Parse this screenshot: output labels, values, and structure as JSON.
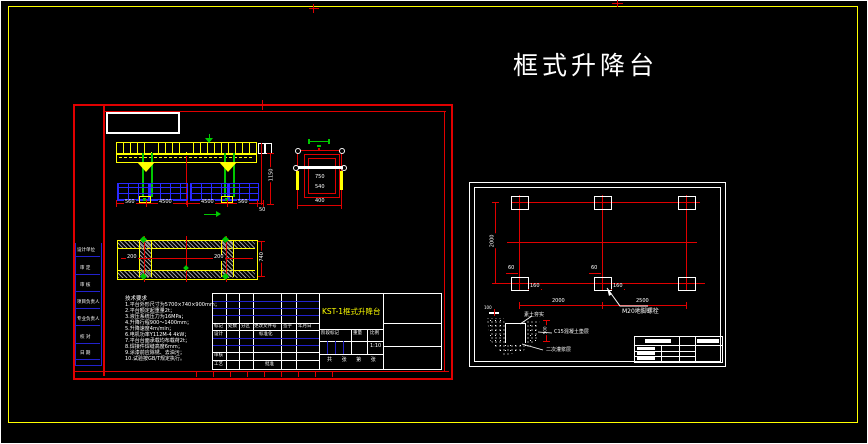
{
  "page": {
    "title": "框式升降台"
  },
  "colors": {
    "red": "#e00000",
    "yellow": "#ffff00",
    "green": "#00c800",
    "blue": "#2222cc",
    "white": "#ffffff",
    "hatch_gray": "#999999"
  },
  "left_sheet": {
    "sidebar": {
      "items": [
        "设计单位",
        "审 定",
        "审 核",
        "项目负责人",
        "专业负责人",
        "校 对",
        "日 期"
      ]
    },
    "front_view": {
      "dims_bottom": [
        "560",
        "4500",
        "4500",
        "560",
        "50"
      ],
      "dim_right": "1150"
    },
    "side_view": {
      "dim_inner_1": "750",
      "dim_inner_2": "540",
      "dim_bottom": "400"
    },
    "plan_view": {
      "dim_1": "200",
      "dim_2": "200",
      "dim_right": "740"
    },
    "notes": {
      "header": "技术要求",
      "lines": [
        "1.平台外形尺寸为5700×740×900mm；",
        "2.平台额定起重量2t；",
        "3.液压系统压力为16MPa；",
        "4.升降行程900～1400mm；",
        "5.升降速度4m/min；",
        "6.电机功率Y112M-4  4kW；",
        "7.平台台面承载均布载荷2t；",
        "8.焊接件焊缝高度6mm；",
        "9.涂漆前应除锈、去油污；",
        "10.试验按GB/T规定执行。"
      ]
    },
    "title_block": {
      "drawing_title": "KST-1框式升降台",
      "header_cells": [
        "标记",
        "处数",
        "分区",
        "更改文件号",
        "签字",
        "年月日"
      ],
      "design_label": "设计",
      "standardization_label": "标准化",
      "check_label": "审核",
      "process_label": "工艺",
      "approve_label": "批准",
      "stage_label": "阶段标记",
      "weight_label": "重量",
      "scale_label": "比例",
      "scale_value": "1:10",
      "sheet_info": "共 张 第 张"
    }
  },
  "right_sheet": {
    "foundation_plan": {
      "dim_left": "2000",
      "dims_bottom": [
        "2000",
        "2500"
      ],
      "anchor_dim_a1": "60",
      "anchor_dim_a2": "160",
      "anchor_dim_b1": "60",
      "anchor_dim_b2": "160",
      "anchor_label": "M20地脚螺栓"
    },
    "detail": {
      "dim_top": "100",
      "dim_right": "500",
      "labels": [
        "素土夯实",
        "C15混凝土垫层",
        "二次灌浆层"
      ]
    }
  }
}
